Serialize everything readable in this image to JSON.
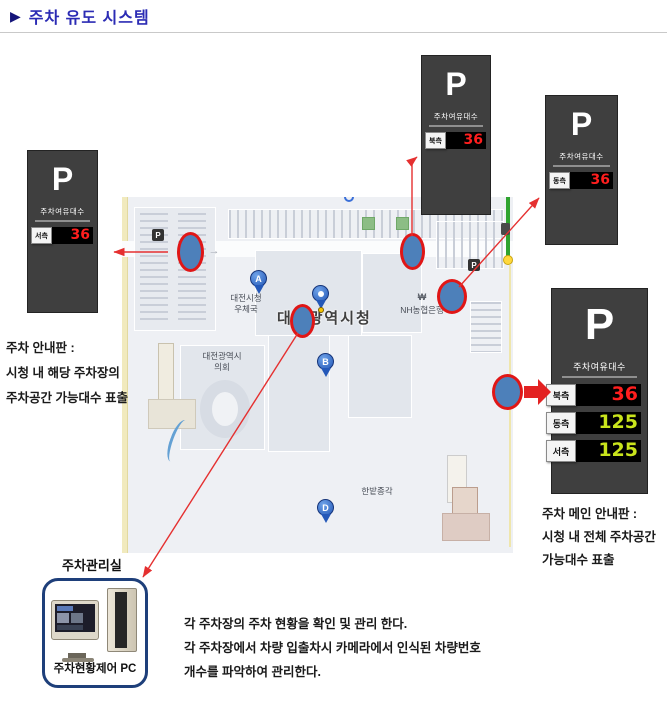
{
  "title": {
    "bullet": "▶",
    "text": "주차 유도 시스템"
  },
  "colors": {
    "title_blue": "#2b2bb4",
    "sign_bg": "#3f3f3f",
    "value_red": "#ff1e1e",
    "value_green": "#c9e41c",
    "arrow_red": "#e53030",
    "spot_blue": "#4d80ba"
  },
  "signs": {
    "p": "P",
    "header": "주차여유대수",
    "west": {
      "label": "서측",
      "value": "36"
    },
    "north": {
      "label": "북측",
      "value": "36"
    },
    "east": {
      "label": "동측",
      "value": "36"
    },
    "main": {
      "p": "P",
      "header": "주차여유대수",
      "rows": [
        {
          "label": "북측",
          "value": "36"
        },
        {
          "label": "동측",
          "value": "125"
        },
        {
          "label": "서측",
          "value": "125"
        }
      ]
    }
  },
  "map": {
    "post_office_line1": "대전시청",
    "post_office_line2": "우체국",
    "city_hall": "대전광역시청",
    "bank": "NH농협은행",
    "bank_symbol": "₩",
    "council_line1": "대전광역시",
    "council_line2": "의회",
    "bell_pavilion": "한밭종각",
    "marker_a": "A",
    "marker_b": "B",
    "marker_d": "D",
    "p_icon": "P",
    "road_arrow": "→"
  },
  "notes": {
    "left": {
      "line1": "주차 안내판 :",
      "line2": "시청 내  해당 주차장의",
      "line3": "주차공간 가능대수 표출"
    },
    "right": {
      "line1": "주차 메인 안내판 :",
      "line2": "시청 내 전체 주차공간",
      "line3": "가능대수 표출"
    },
    "bottom": {
      "line1": "각 주차장의 주차 현황을 확인 및 관리 한다.",
      "line2": "각 주차장에서 차량 입출차시 카메라에서 인식된 차량번호",
      "line3": "개수를 파악하여 관리한다."
    }
  },
  "control_room": {
    "title": "주차관리실",
    "pc_label": "주차현황제어 PC"
  }
}
